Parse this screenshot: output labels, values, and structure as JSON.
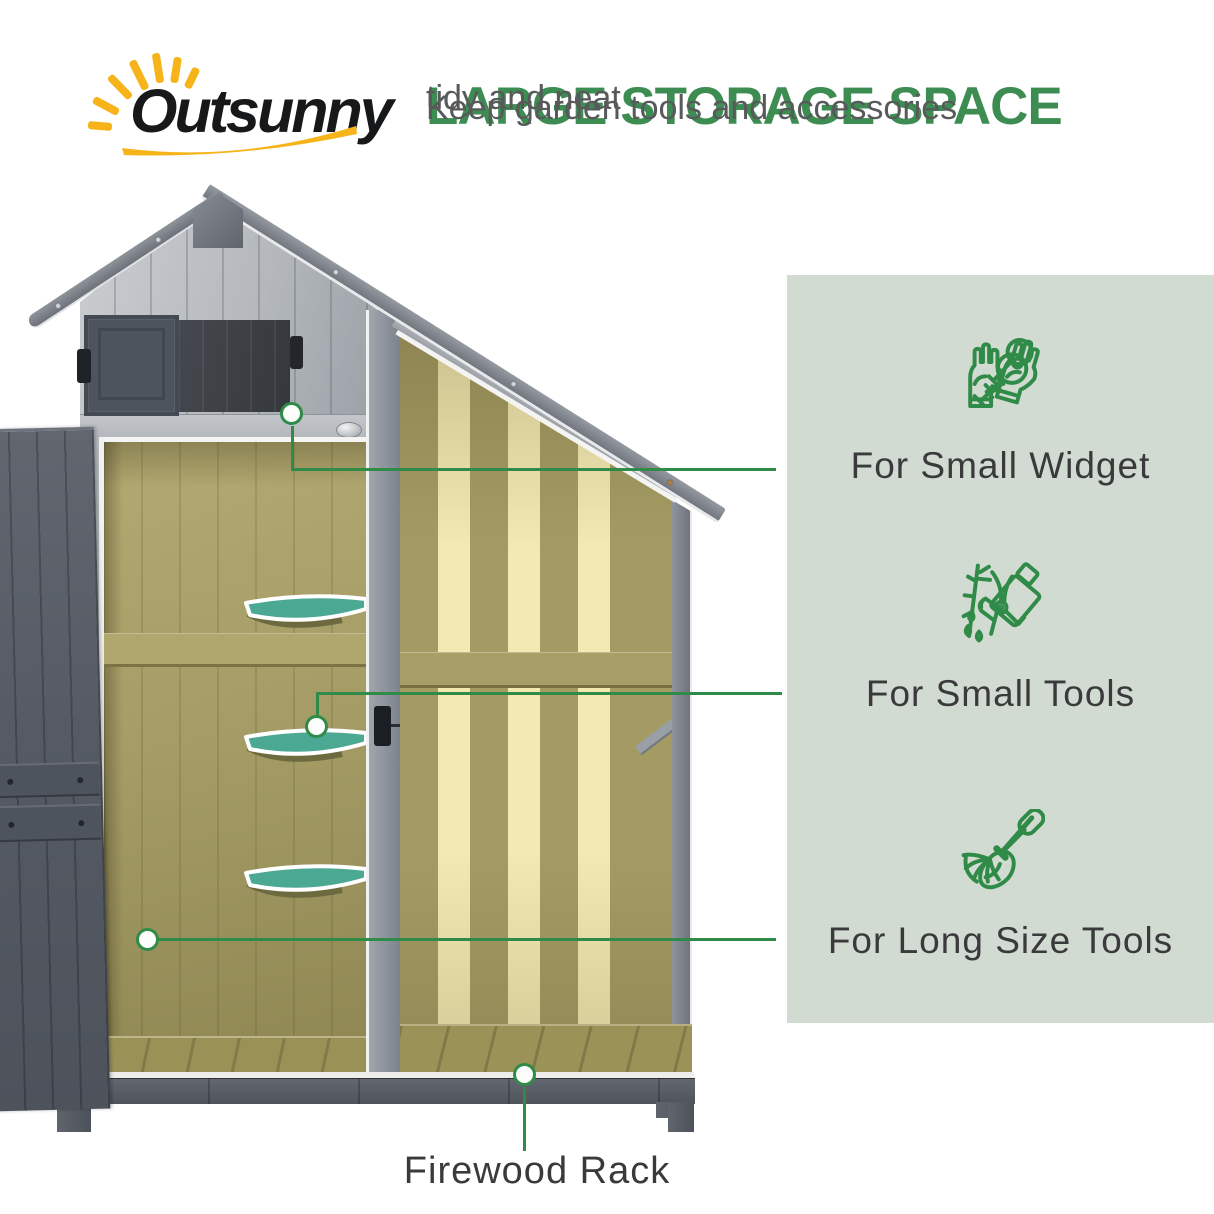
{
  "logo": {
    "brand": "Outsunny"
  },
  "header": {
    "title": "LARGE STORAGE SPACE",
    "subtitle_line1": "Keep garden tools and accessories",
    "subtitle_line2": "tidy and neat"
  },
  "panel": {
    "features": [
      {
        "icons": [
          "gloves-icon",
          "keys-icon"
        ],
        "label": "For Small Widget"
      },
      {
        "icons": [
          "pruning-shears-icon",
          "watering-can-icon"
        ],
        "label": "For Small Tools"
      },
      {
        "icons": [
          "rake-icon",
          "shovel-icon"
        ],
        "label": "For Long Size Tools"
      }
    ]
  },
  "callouts": {
    "firewood_label": "Firewood Rack",
    "marker_count": 4
  },
  "colors": {
    "accent_green": "#2f8b47",
    "heading_green": "#3d8d52",
    "panel_bg": "#d2dbd1",
    "label_text": "#3a3a3c",
    "subtitle_gray": "#58595b",
    "logo_yellow": "#f6b41a",
    "shelf_teal": "#4aa893",
    "wood_olive": "#a59c66",
    "slat_light": "#f3e9b2",
    "shed_gray": "#9aa0a8",
    "door_gray": "#575d67"
  }
}
